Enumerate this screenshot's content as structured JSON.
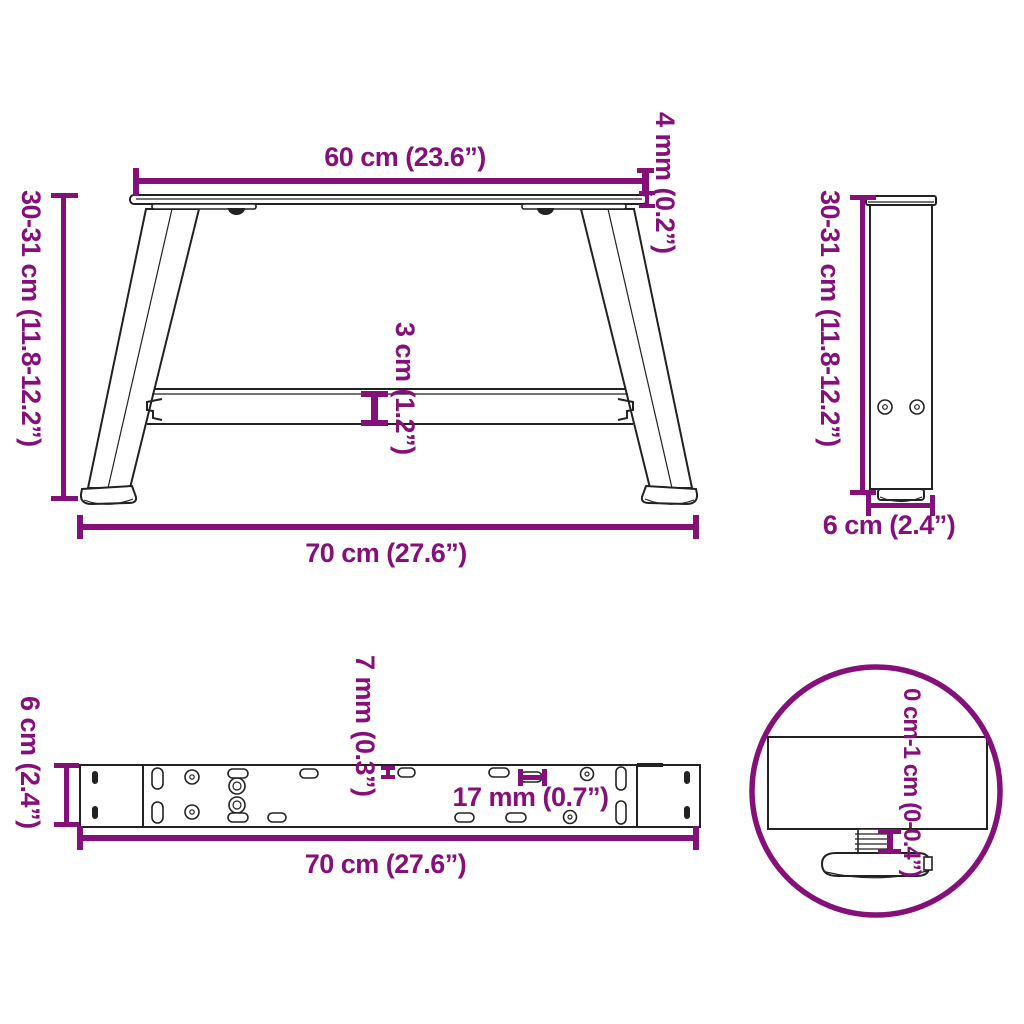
{
  "colors": {
    "accent": "#86107a",
    "ink": "#222222"
  },
  "front_view": {
    "top_width": "60 cm (23.6”)",
    "plate_thickness": "4 mm (0.2”)",
    "height": "30-31 cm (11.8-12.2”)",
    "crossbar_height": "3 cm (1.2”)",
    "bottom_width": "70 cm (27.6”)"
  },
  "side_view": {
    "height": "30-31 cm (11.8-12.2”)",
    "depth": "6 cm (2.4”)"
  },
  "top_view": {
    "depth": "6 cm (2.4”)",
    "hole_diameter": "7 mm (0.3”)",
    "slot_length": "17 mm (0.7”)",
    "length": "70 cm (27.6”)"
  },
  "detail_view": {
    "adjustment_range": "0 cm-1 cm (0-0.4”)"
  }
}
